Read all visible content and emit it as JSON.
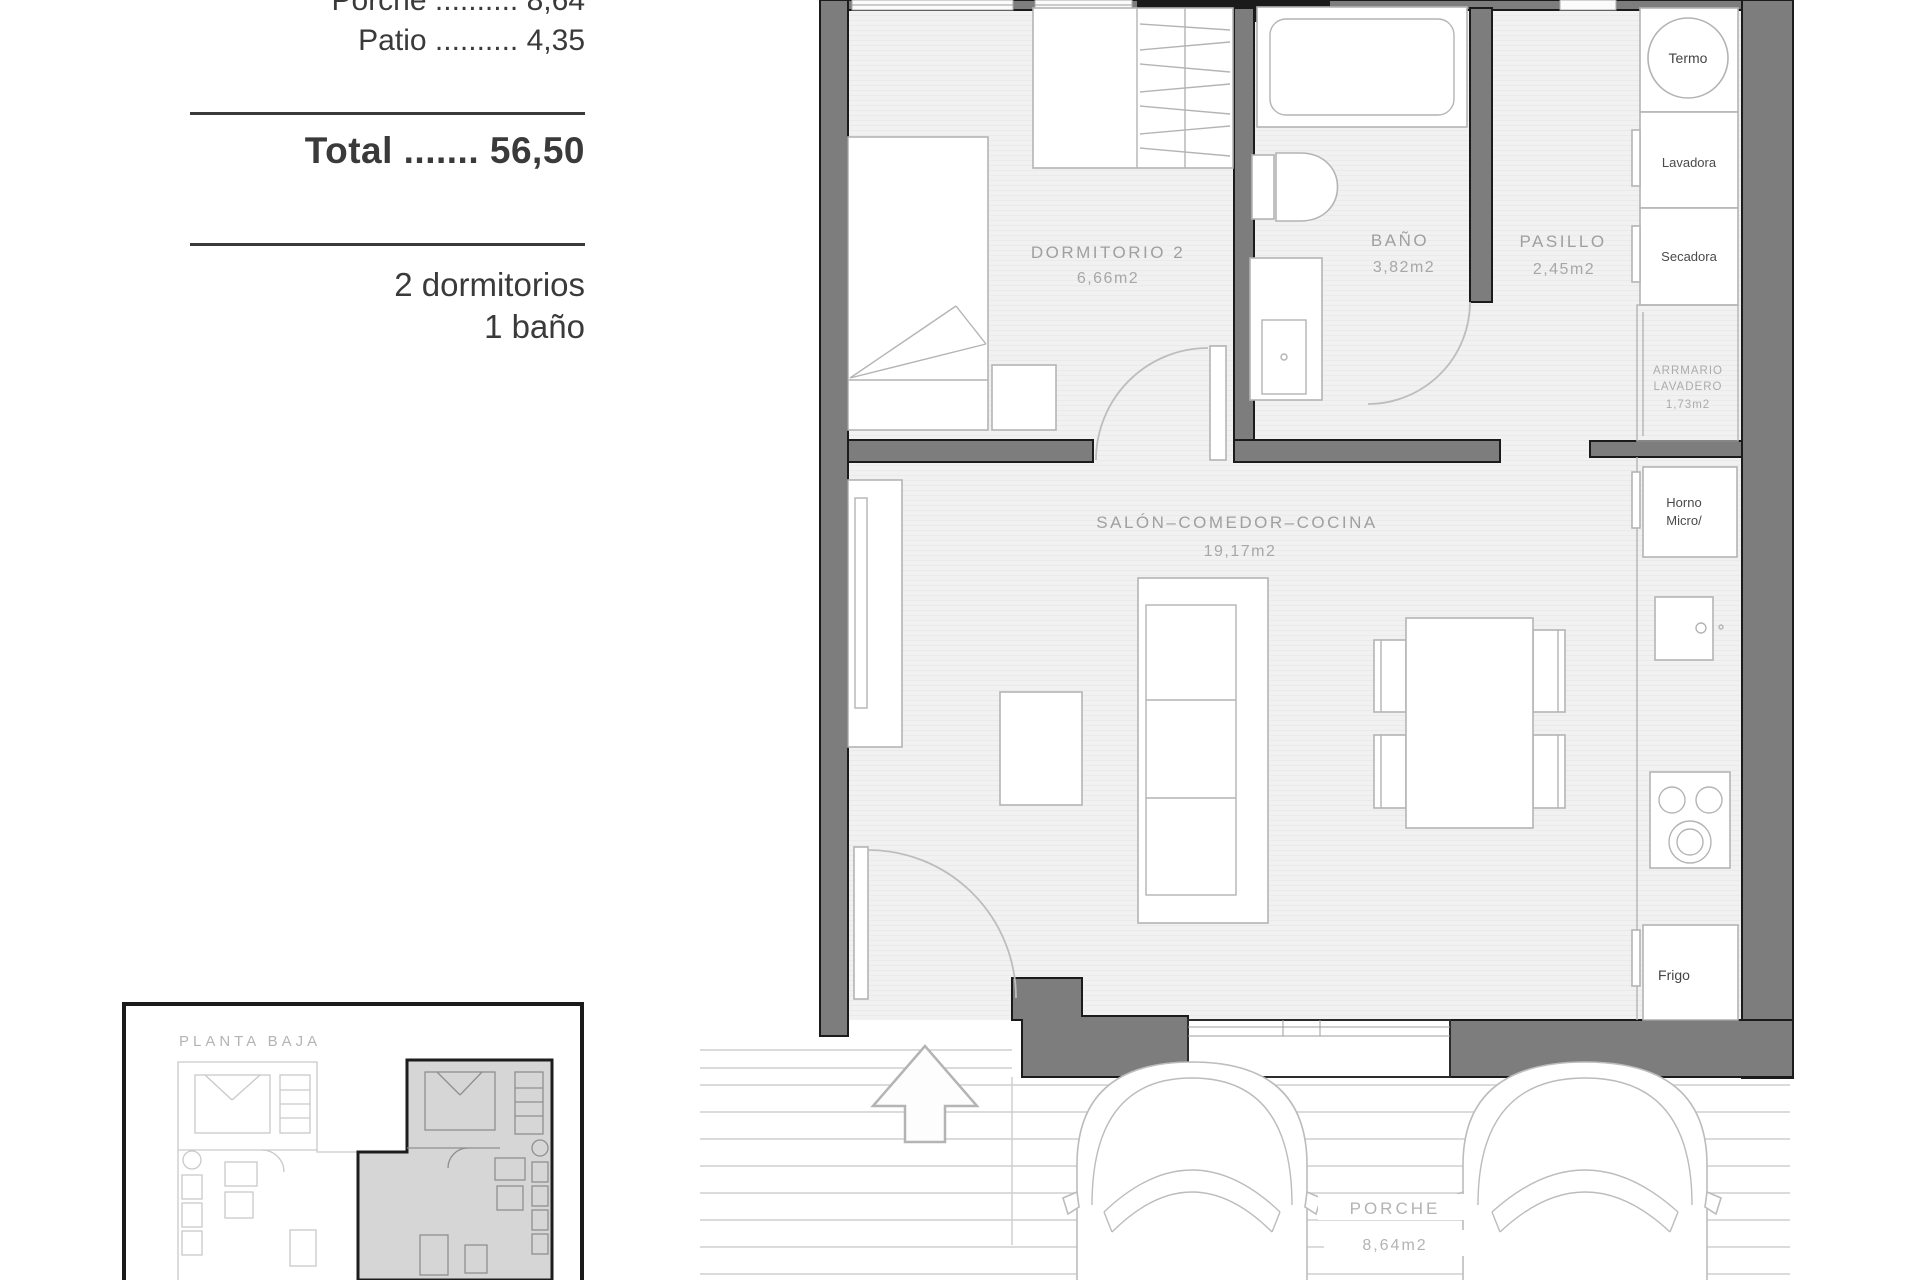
{
  "summary": {
    "rows": [
      {
        "label": "Porche",
        "dots": "..........",
        "value": "8,64"
      },
      {
        "label": "Patio",
        "dots": "..........",
        "value": "4,35"
      }
    ],
    "total": {
      "label": "Total",
      "dots": ".......",
      "value": "56,50"
    },
    "features": {
      "bedrooms": "2 dormitorios",
      "bathrooms": "1 baño"
    }
  },
  "plan": {
    "rooms": {
      "dormitorio2": {
        "name": "DORMITORIO 2",
        "area": "6,66m2"
      },
      "bano": {
        "name": "BAÑO",
        "area": "3,82m2"
      },
      "pasillo": {
        "name": "PASILLO",
        "area": "2,45m2"
      },
      "salon": {
        "name": "SALÓN–COMEDOR–COCINA",
        "area": "19,17m2"
      },
      "armario": {
        "line1": "ARRMARIO",
        "line2": "LAVADERO",
        "area": "1,73m2"
      },
      "porche": {
        "name": "PORCHE",
        "area": "8,64m2"
      }
    },
    "appliances": {
      "termo": "Termo",
      "lavadora": "Lavadora",
      "secadora": "Secadora",
      "horno": "Horno",
      "micro": "Micro/",
      "frigo": "Frigo"
    }
  },
  "thumbnail": {
    "title": "PLANTA BAJA"
  },
  "colors": {
    "wall": "#7d7d7d",
    "wall_outline": "#1b1b1b",
    "floor": "#f1f1f1",
    "drawing_line": "#b4b4b4",
    "room_label": "#9f9f9f",
    "ink_text": "#3a3a3a",
    "thumbnail_highlight": "#d6d6d6"
  }
}
